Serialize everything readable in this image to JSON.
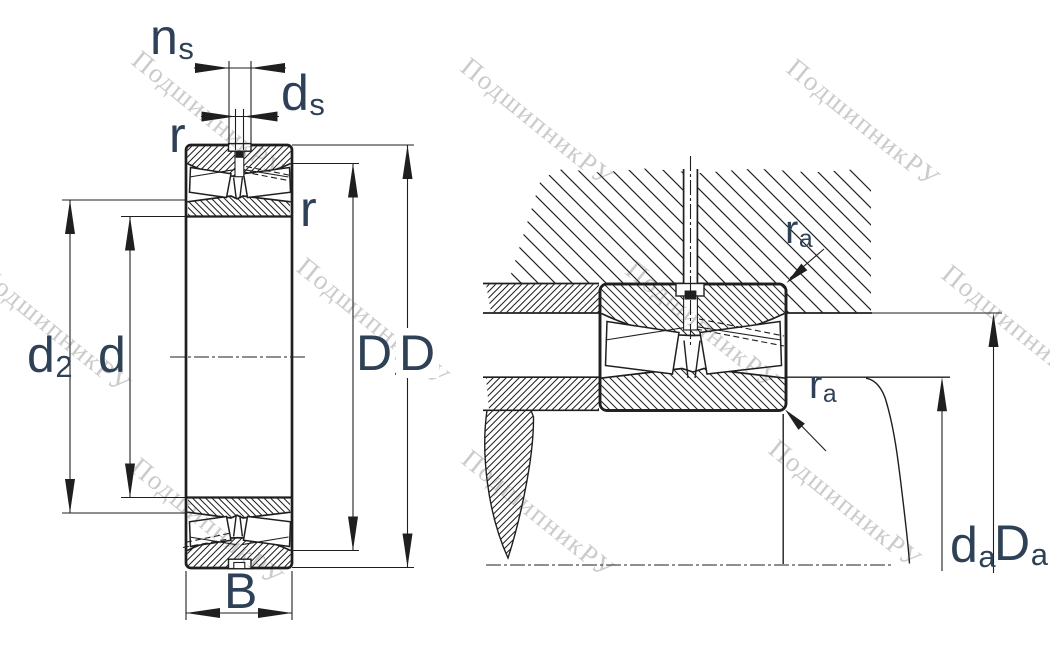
{
  "drawing": "spherical roller bearing – section view and mounting abutment view",
  "watermark": {
    "text": "ПодшипникРУ"
  },
  "labels": {
    "ns": {
      "main": "n",
      "sub": "s"
    },
    "ds": {
      "main": "d",
      "sub": "s"
    },
    "r_top": {
      "main": "r",
      "sub": ""
    },
    "r_right": {
      "main": "r",
      "sub": ""
    },
    "d2": {
      "main": "d",
      "sub": "2"
    },
    "d": {
      "main": "d",
      "sub": ""
    },
    "D1": {
      "main": "D",
      "sub": "1"
    },
    "D": {
      "main": "D",
      "sub": ""
    },
    "B": {
      "main": "B",
      "sub": ""
    },
    "ra_top": {
      "main": "r",
      "sub": "a"
    },
    "ra_bottom": {
      "main": "r",
      "sub": "a"
    },
    "da": {
      "main": "d",
      "sub": "a"
    },
    "Da": {
      "main": "D",
      "sub": "a"
    }
  },
  "colors": {
    "line": "#1f1f1f",
    "label": "#2e4156",
    "watermark": "#cbcbcb",
    "background": "#ffffff"
  }
}
